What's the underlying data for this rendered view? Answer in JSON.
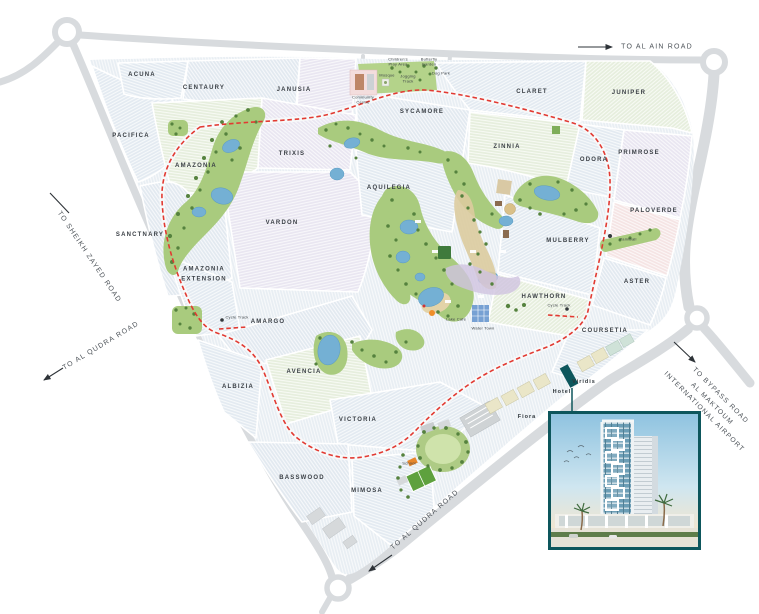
{
  "map": {
    "cluster_labels": {
      "acuna": "ACUNA",
      "centaury": "CENTAURY",
      "janusia": "JANUSIA",
      "pacifica": "PACIFICA",
      "amazonia": "AMAZONIA",
      "trixis": "TRIXIS",
      "sycamore": "SYCAMORE",
      "claret": "CLARET",
      "juniper": "JUNIPER",
      "zinnia": "ZINNIA",
      "odora": "ODORA",
      "primrose": "PRIMROSE",
      "aquilegia": "AQUILEGIA",
      "paloverde": "PALOVERDE",
      "sanctnary": "SANCTNARY",
      "vardon": "VARDON",
      "mulberry": "MULBERRY",
      "amazonia_extension_line1": "AMAZONIA",
      "amazonia_extension_line2": "EXTENSION",
      "aster": "ASTER",
      "hawthorn": "HAWTHORN",
      "amargo": "AMARGO",
      "coursetia": "COURSETIA",
      "albizia": "ALBIZIA",
      "avencia": "AVENCIA",
      "victoria": "VICTORIA",
      "basswood": "BASSWOOD",
      "mimosa": "MIMOSA"
    },
    "place_labels": {
      "fiora": "Fiora",
      "hotel": "Hotel",
      "viridis": "Viridis",
      "school": "School"
    },
    "road_labels": {
      "al_ain": "TO AL AIN ROAD",
      "sheikh_zayed": "TO SHEIKH ZAYED ROAD",
      "al_qudra_west": "TO AL QUDRA ROAD",
      "al_qudra_south": "TO AL QUDRA ROAD",
      "bypass_line1": "TO BYPASS ROAD",
      "bypass_line2": "AL MAKTOUM",
      "bypass_line3": "INTERNATIONAL AIRPORT"
    },
    "amenity_labels": {
      "community_centre": "Community Centre",
      "mosque": "Mosque",
      "jogging_track": "Jogging Track",
      "childrens_play_area": "Children's Play Area",
      "butterfly_garden": "Butterfly Garden",
      "dog_park": "Dog Park",
      "paintball": "Paintball",
      "cycle_track_1": "Cycle Track",
      "cycle_track_2": "Cycle Track",
      "lake_cafe": "Lake Cafe",
      "water_town": "Water Town"
    },
    "colors": {
      "road_grey": "#d8dbde",
      "boundary_dash_red": "#e23a32",
      "park_green": "#a9cb7e",
      "pond_blue": "#74b0d4",
      "accent_teal": "#0d565c",
      "label_dark": "#3b4046"
    }
  }
}
